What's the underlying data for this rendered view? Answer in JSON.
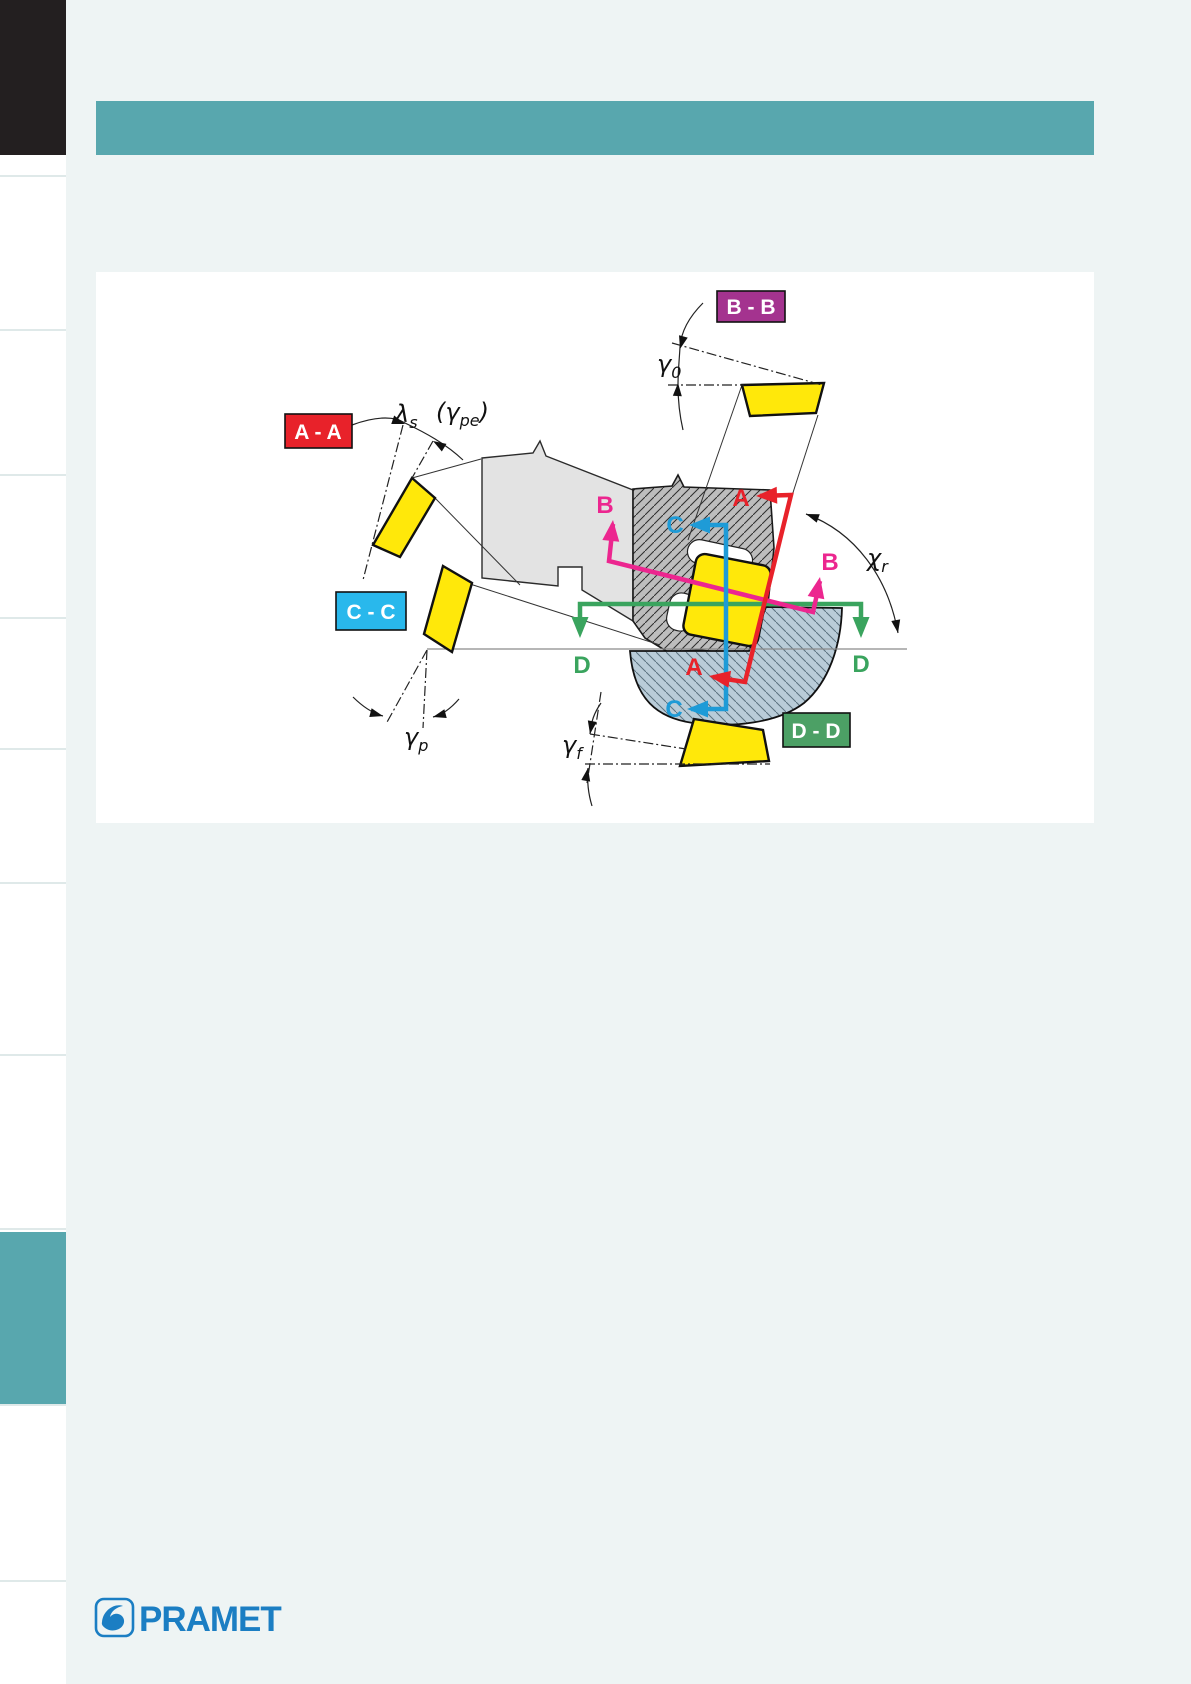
{
  "page": {
    "background": "#eef4f4"
  },
  "top": {
    "corner_tab_color": "#231f20",
    "header_bar_color": "#58a7ae"
  },
  "sidebar": {
    "active_tab_color": "#58a7ae"
  },
  "diagram": {
    "panel_background": "#ffffff",
    "section_boxes": {
      "aa": {
        "text": "A - A",
        "color": "#e8222a"
      },
      "bb": {
        "text": "B - B",
        "color": "#a4338f"
      },
      "cc": {
        "text": "C - C",
        "color": "#29b8ec"
      },
      "dd": {
        "text": "D - D",
        "color": "#4ca065"
      }
    },
    "markers": {
      "a": "A",
      "b": "B",
      "c": "C",
      "d": "D"
    },
    "angle_labels": {
      "lambda_s": {
        "pre": "λ",
        "sub": "s",
        "post": ""
      },
      "gamma_pe": {
        "pre": "(γ",
        "sub": "pe",
        "post": ")"
      },
      "gamma_0": {
        "pre": "γ",
        "sub": "0",
        "post": ""
      },
      "gamma_p": {
        "pre": "γ",
        "sub": "p",
        "post": ""
      },
      "gamma_f": {
        "pre": "γ",
        "sub": "f",
        "post": ""
      },
      "chi_r": {
        "pre": "χ",
        "sub": "r",
        "post": ""
      }
    },
    "line_colors": {
      "a": "#e8222a",
      "b": "#ec268f",
      "c": "#1e9bd7",
      "d": "#3aa45e"
    },
    "part_colors": {
      "insert": "#ffe80a",
      "body": "#e3e3e3",
      "cartridge": "#bdbdbd",
      "workpiece": "#b9ccd8"
    }
  },
  "footer": {
    "logo_text": "PRAMET",
    "logo_color": "#1b7ec3"
  }
}
